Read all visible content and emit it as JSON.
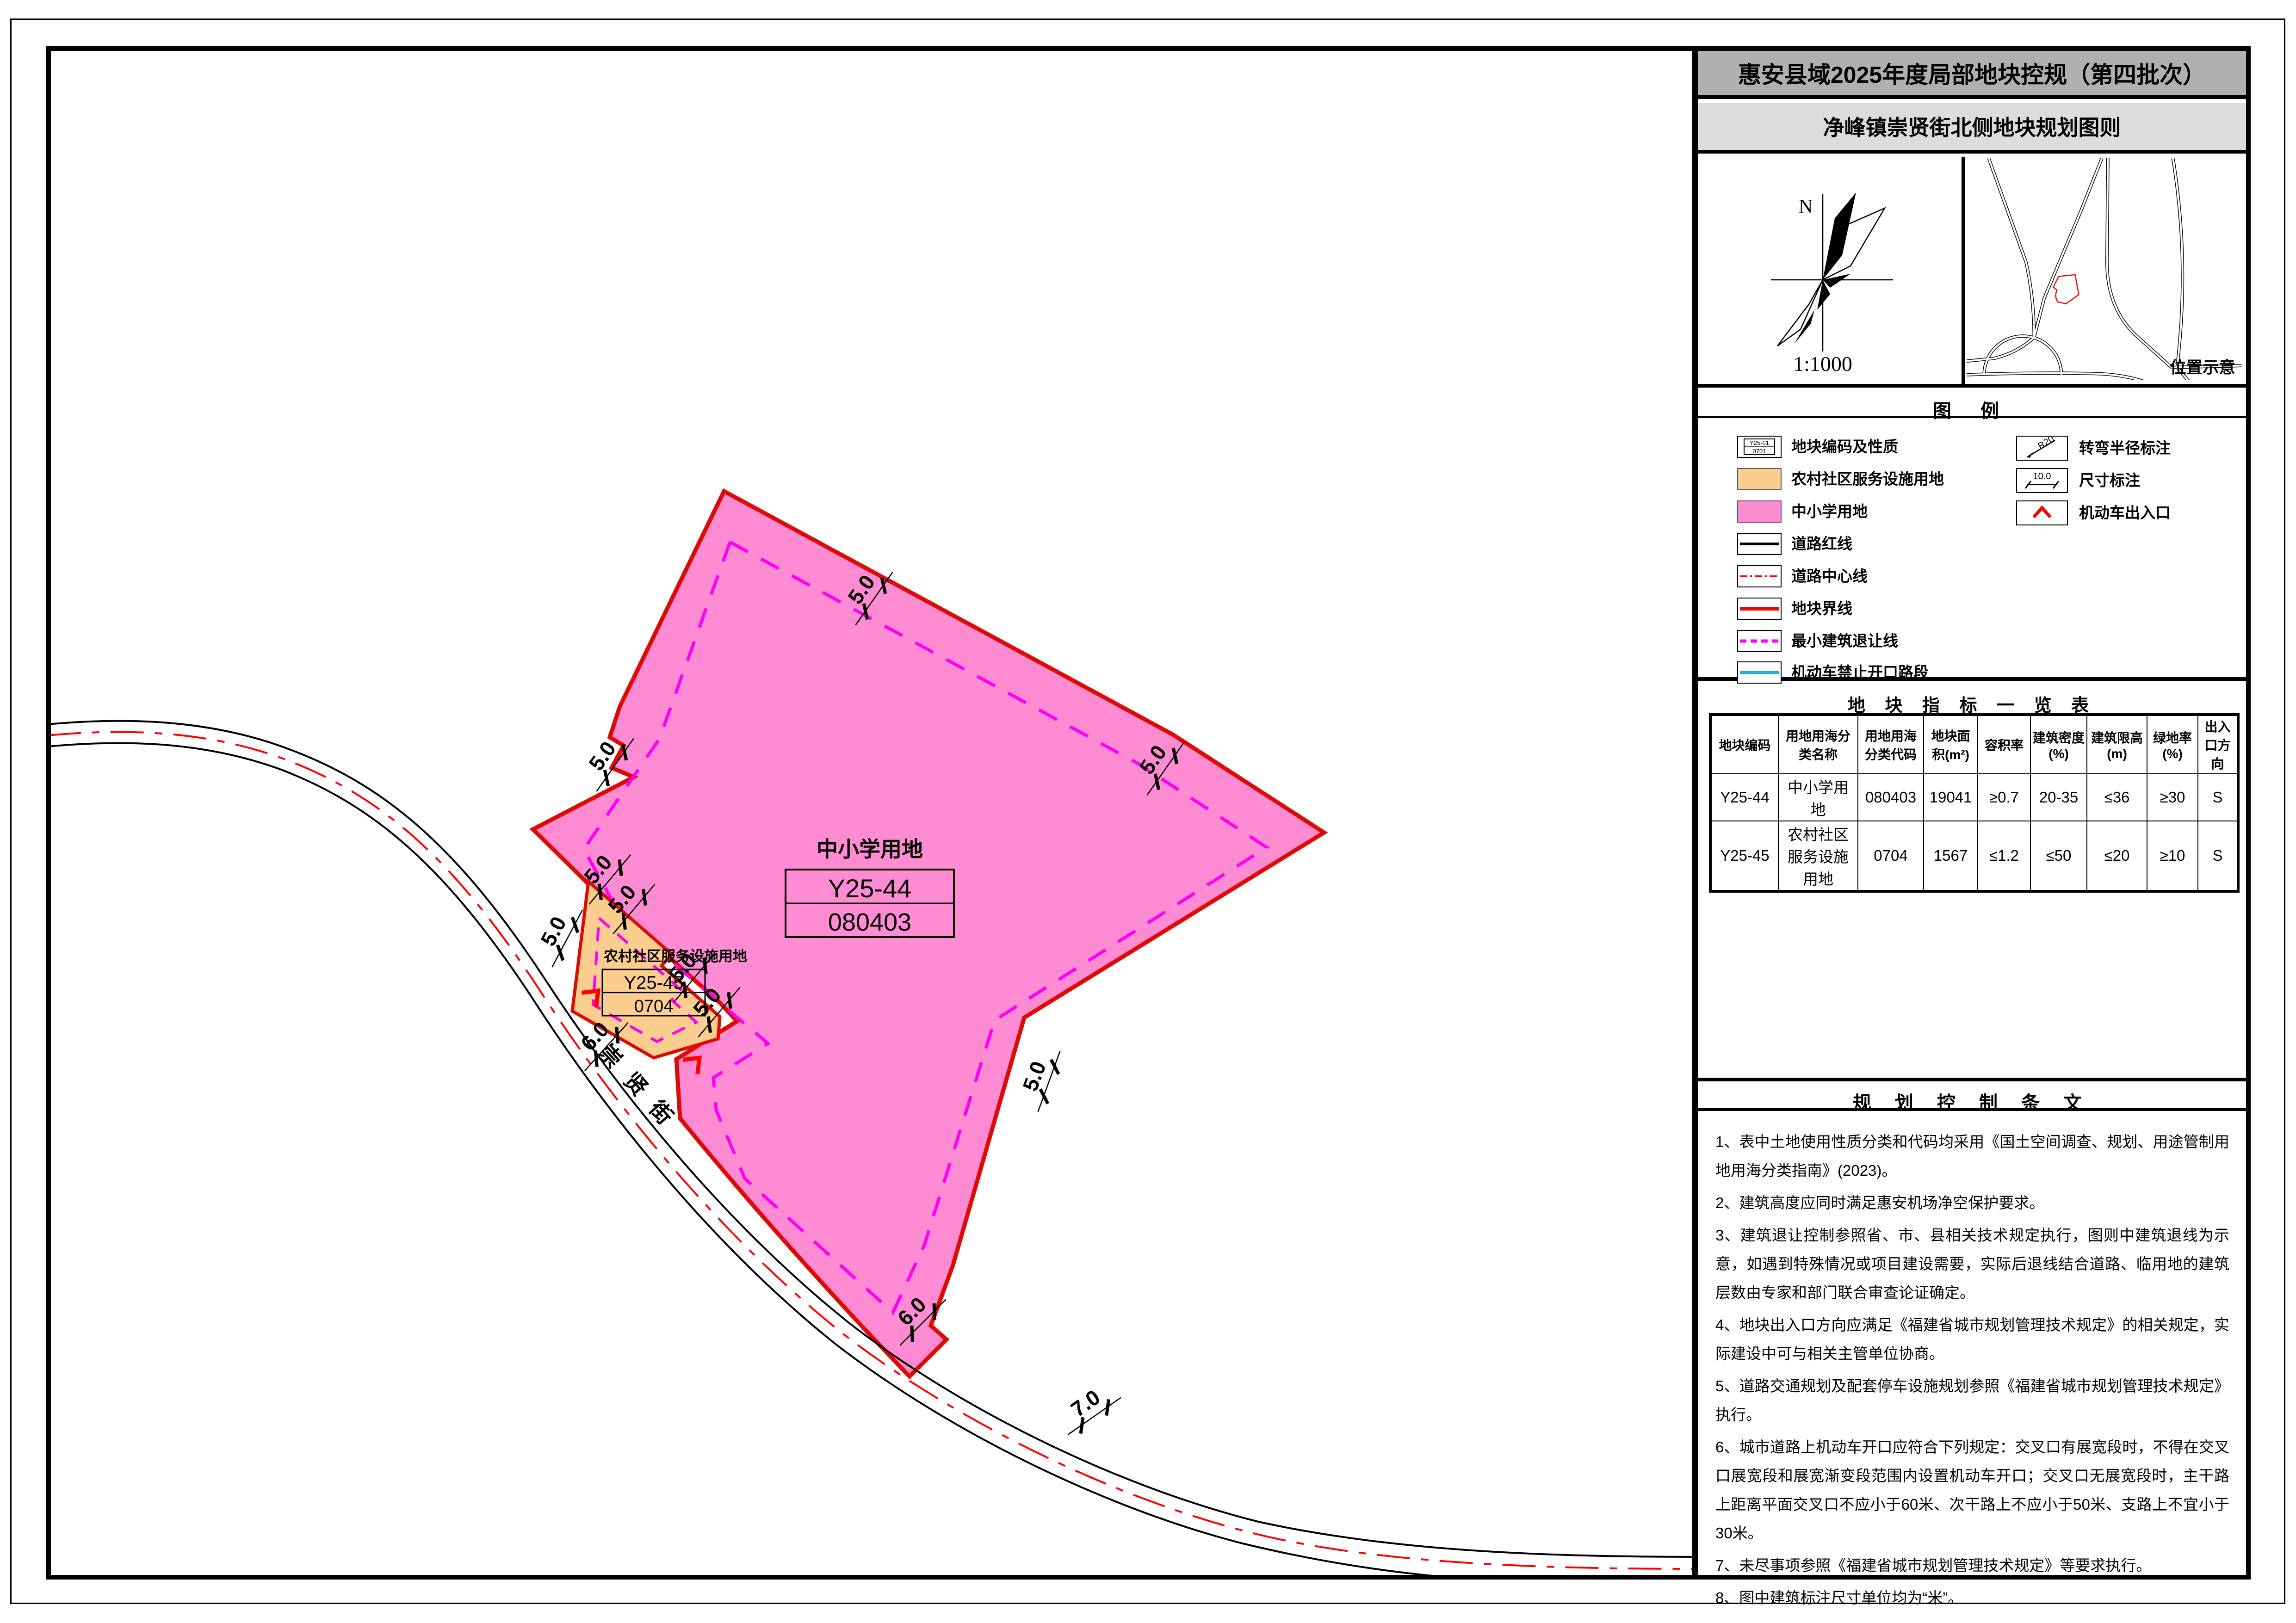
{
  "sheet": {
    "title": "惠安县域2025年度局部地块控规（第四批次）",
    "subtitle": "净峰镇崇贤街北侧地块规划图则"
  },
  "compass": {
    "north_label": "N",
    "scale_label": "1:1000"
  },
  "inset": {
    "caption": "位置示意"
  },
  "map": {
    "street_name": "崇贤街",
    "parcels": [
      {
        "use_label": "中小学用地",
        "code": "Y25-44",
        "class_code": "080403"
      },
      {
        "use_label": "农村社区服务设施用地",
        "code": "Y25-45",
        "class_code": "0704"
      }
    ],
    "dims": [
      {
        "t": "5.0"
      },
      {
        "t": "5.0"
      },
      {
        "t": "5.0"
      },
      {
        "t": "6.0"
      },
      {
        "t": "7.0"
      },
      {
        "t": "5.0"
      },
      {
        "t": "5.0"
      },
      {
        "t": "5.0"
      },
      {
        "t": "5.0"
      },
      {
        "t": "5.0"
      },
      {
        "t": "5.0"
      },
      {
        "t": "6.0"
      }
    ]
  },
  "legend": {
    "title": "图  例",
    "sample": {
      "code": "Y25-01",
      "class_code": "0701"
    },
    "left_items": [
      {
        "label": "地块编码及性质"
      },
      {
        "label": "农村社区服务设施用地"
      },
      {
        "label": "中小学用地"
      },
      {
        "label": "道路红线"
      },
      {
        "label": "道路中心线"
      },
      {
        "label": "地块界线"
      },
      {
        "label": "最小建筑退让线"
      },
      {
        "label": "机动车禁止开口路段"
      }
    ],
    "right_items": [
      {
        "label": "转弯半径标注",
        "icon_text": "R20"
      },
      {
        "label": "尺寸标注",
        "icon_text": "10.0"
      },
      {
        "label": "机动车出入口"
      }
    ]
  },
  "table": {
    "title": "地 块 指 标 一 览 表",
    "headers": [
      "地块编码",
      "用地用海分类名称",
      "用地用海分类代码",
      "地块面积(m²)",
      "容积率",
      "建筑密度(%)",
      "建筑限高(m)",
      "绿地率(%)",
      "出入口方向"
    ],
    "rows": [
      [
        "Y25-44",
        "中小学用地",
        "080403",
        "19041",
        "≥0.7",
        "20-35",
        "≤36",
        "≥30",
        "S"
      ],
      [
        "Y25-45",
        "农村社区服务设施用地",
        "0704",
        "1567",
        "≤1.2",
        "≤50",
        "≤20",
        "≥10",
        "S"
      ]
    ]
  },
  "notes": {
    "title": "规 划 控 制 条 文",
    "items": [
      "1、表中土地使用性质分类和代码均采用《国土空间调查、规划、用途管制用地用海分类指南》(2023)。",
      "2、建筑高度应同时满足惠安机场净空保护要求。",
      "3、建筑退让控制参照省、市、县相关技术规定执行，图则中建筑退线为示意，如遇到特殊情况或项目建设需要，实际后退线结合道路、临用地的建筑层数由专家和部门联合审查论证确定。",
      "4、地块出入口方向应满足《福建省城市规划管理技术规定》的相关规定，实际建设中可与相关主管单位协商。",
      "5、道路交通规划及配套停车设施规划参照《福建省城市规划管理技术规定》执行。",
      "6、城市道路上机动车开口应符合下列规定：交叉口有展宽段时，不得在交叉口展宽段和展宽渐变段范围内设置机动车开口；交叉口无展宽段时，主干路上距离平面交叉口不应小于60米、次干路上不应小于50米、支路上不宜小于30米。",
      "7、未尽事项参照《福建省城市规划管理技术规定》等要求执行。",
      "8、图中建筑标注尺寸单位均为“米”。"
    ]
  },
  "colors": {
    "school_pink": "#FF8CD2",
    "rural_orange": "#FBCE8F",
    "parcel_boundary_red": "#DE0A05",
    "setback_magenta": "#FF00F0",
    "road_centerline_red": "#FF0000",
    "no_access_cyan": "#29ABE2",
    "title_bar_gray": "#B0B0B0",
    "subtitle_bar_gray": "#DCDCDC"
  }
}
